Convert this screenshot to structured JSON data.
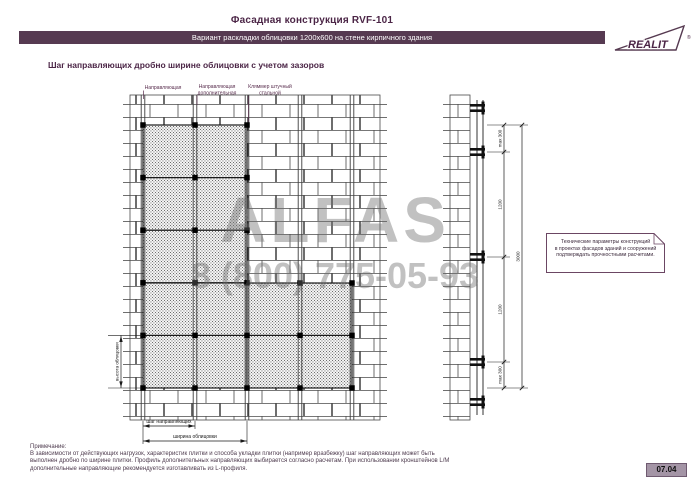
{
  "header": {
    "title": "Фасадная конструкция RVF-101",
    "subtitle": "Вариант раскладки облицовки 1200x600 на стене кирпичного здания",
    "logo_text": "REALIT",
    "logo_reg": "®"
  },
  "section_title": "Шаг направляющих дробно ширине облицовки с учетом зазоров",
  "drawing": {
    "labels": {
      "rail": "Направляющая",
      "rail_additional_1": "Направляющая",
      "rail_additional_2": "дополнительная",
      "clamp_1": "Кляммер штучный",
      "clamp_2": "стальной",
      "step": "шаг направляющих",
      "width": "ширина облицовки",
      "height": "высота облицовки"
    },
    "dimensions": {
      "top_offset": "max 300",
      "span1": "1200",
      "total": "3000",
      "span2": "1200",
      "bottom_offset": "max 300"
    }
  },
  "note_box": {
    "line1": "Технические параметры конструкций",
    "line2": "в проектах фасадов зданий и сооружений",
    "line3": "подтверждать прочностными расчетами."
  },
  "watermark": {
    "name": "ALFAS",
    "phone": "8 (800) 775-05-93"
  },
  "footnote": {
    "title": "Примечание:",
    "line1": "В зависимости от действующих нагрузок, характеристик плитки и способа укладки плитки (например вразбежку) шаг направляющих может быть",
    "line2": "выполнен дробно по ширине плитки. Профиль дополнительных направляющих выбирается согласно расчетам. При использовании кронштейнов L/M",
    "line3": "дополнительные направляющие рекомендуется изготавливать из L-профиля."
  },
  "page_number": "07.04",
  "colors": {
    "accent": "#563a51",
    "title": "#4b2546",
    "watermark_gray": "#c7c7c7"
  }
}
